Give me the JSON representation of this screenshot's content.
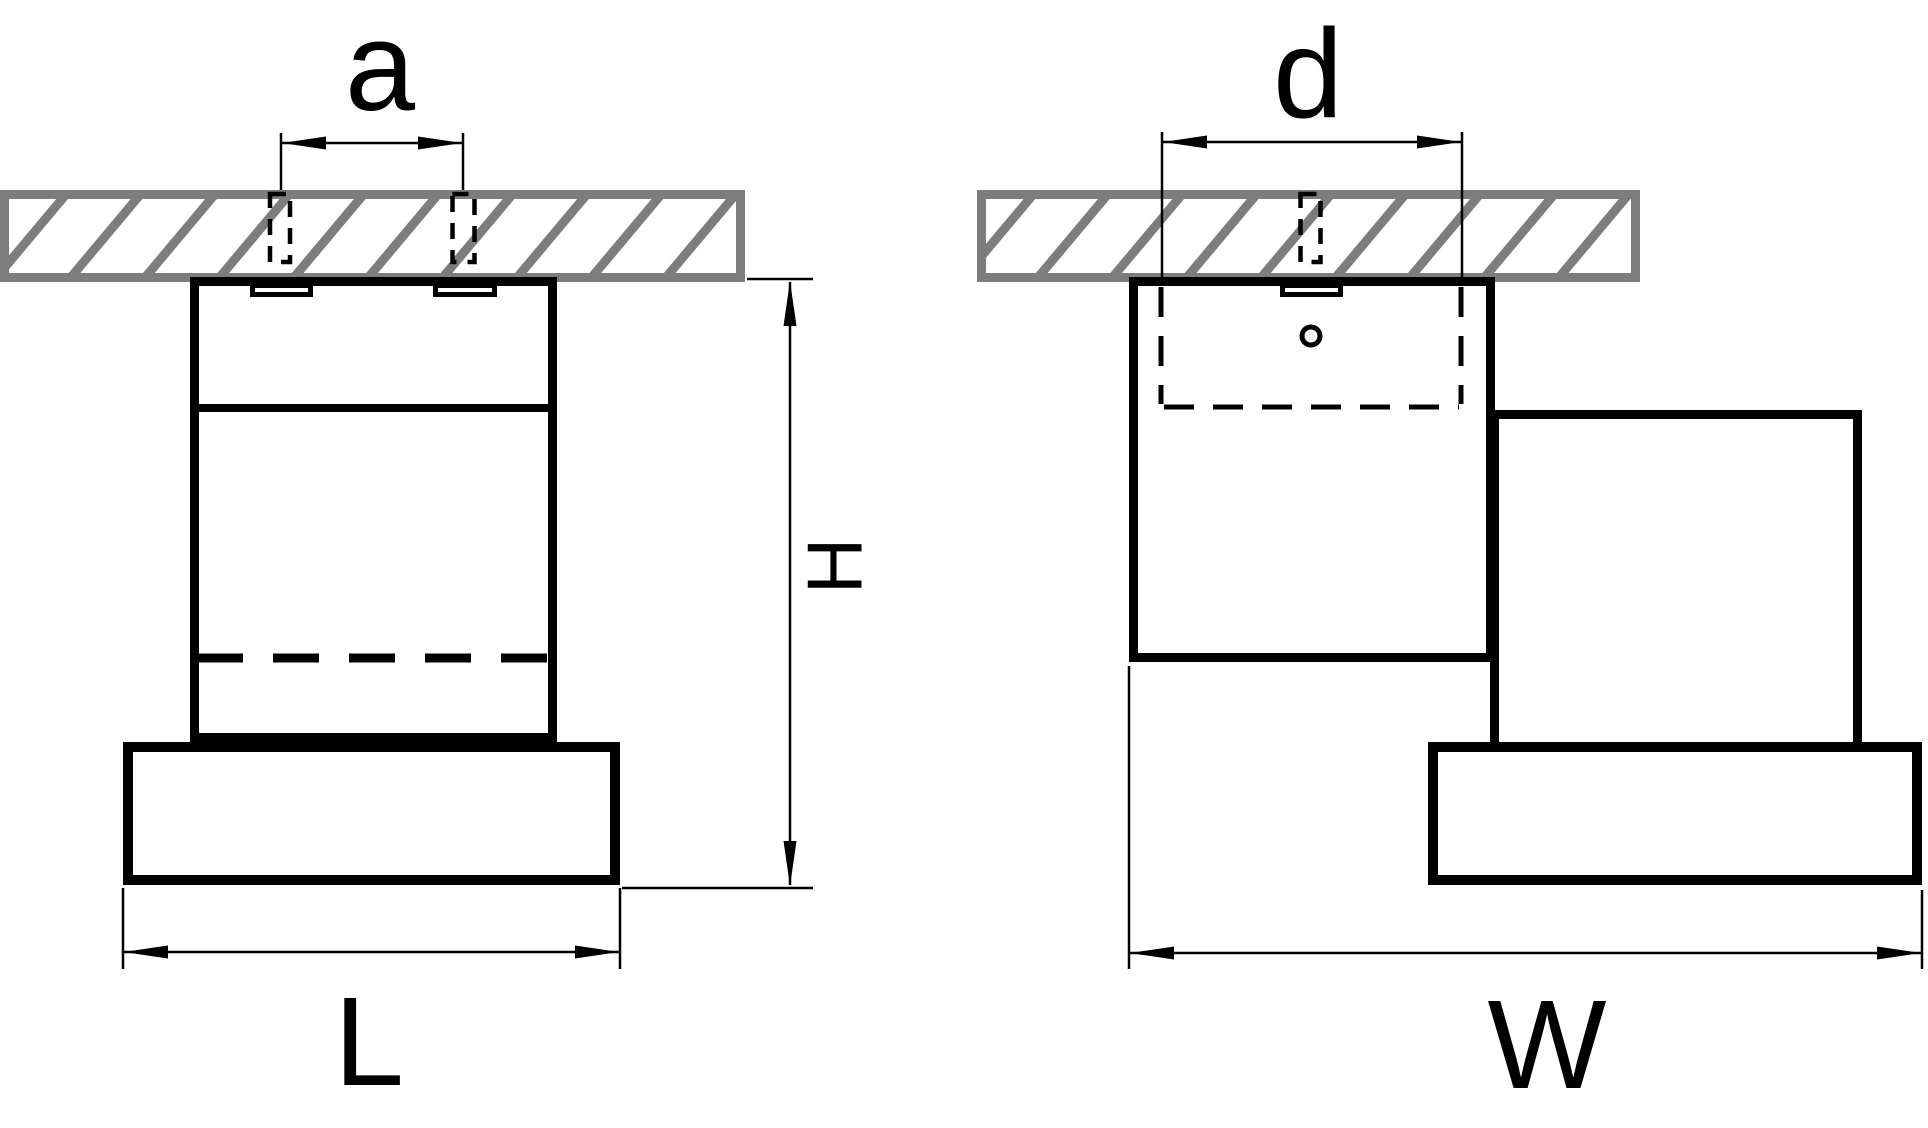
{
  "labels": {
    "a": "a",
    "d": "d",
    "H": "H",
    "L": "L",
    "W": "W"
  },
  "colors": {
    "line": "#000000",
    "hatch": "#7d7d7d",
    "background": "#ffffff"
  }
}
